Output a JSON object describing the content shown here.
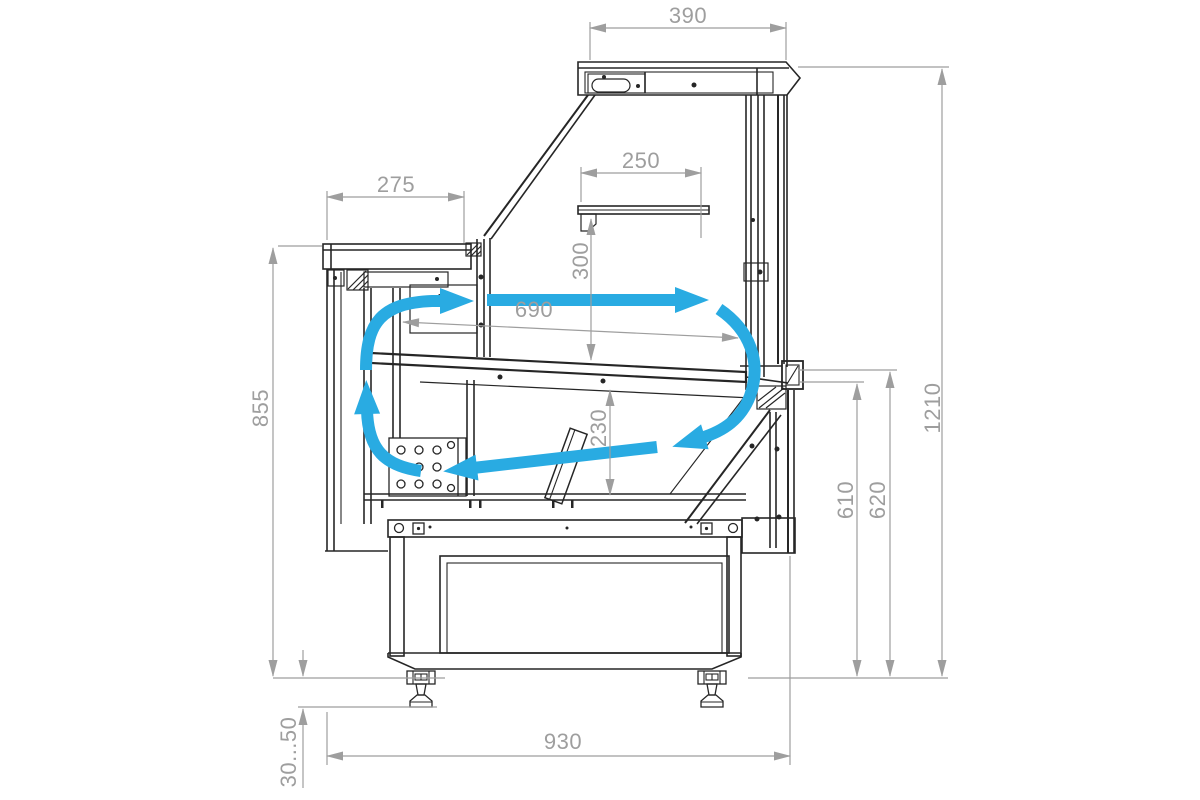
{
  "drawing": {
    "kind": "technical-cross-section",
    "subject": "refrigerated serve-over display counter, side section with air circulation",
    "background_color": "#ffffff",
    "outline_color": "#262626",
    "dimension_color": "#9e9e9e",
    "airflow_color": "#29ABE2"
  },
  "dims": {
    "d390": "390",
    "d275": "275",
    "d250": "250",
    "d300": "300",
    "d690": "690",
    "d230": "230",
    "d855": "855",
    "d610": "610",
    "d620": "620",
    "d1210": "1210",
    "d930": "930",
    "d30_50": "30...50"
  },
  "airflow": {
    "arrows": [
      "rear-duct-rise",
      "top-air-curtain",
      "front-glass-descent",
      "bottom-return",
      "left-riser"
    ]
  }
}
